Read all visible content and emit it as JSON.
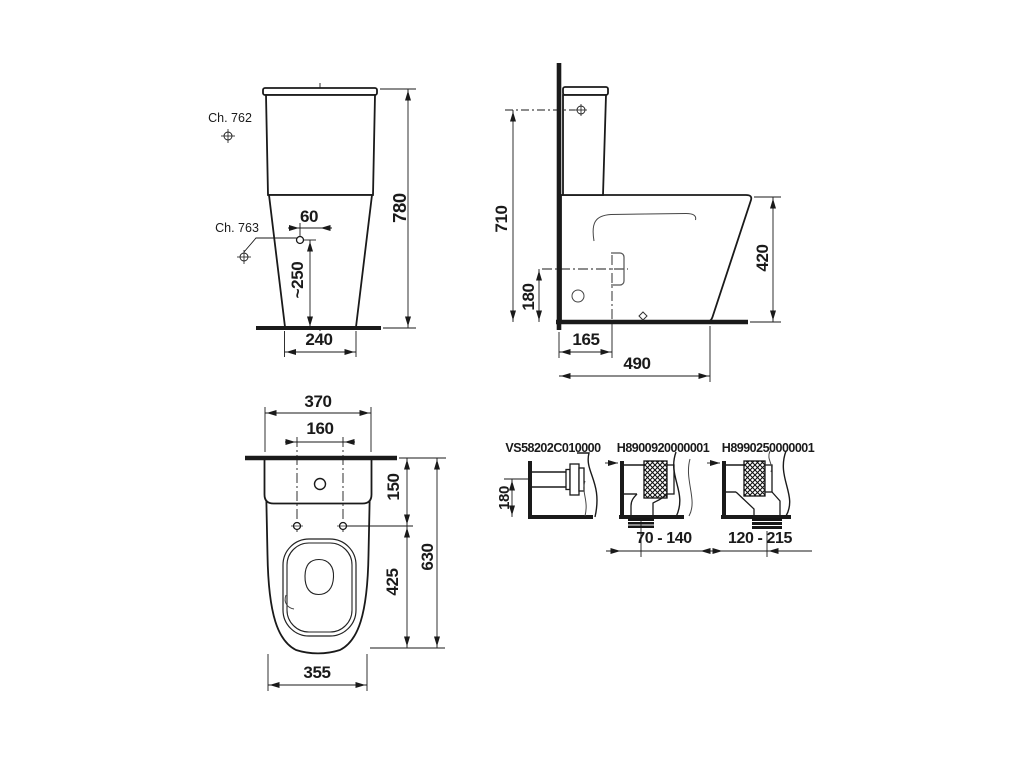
{
  "drawing": {
    "front": {
      "ch762": "Ch. 762",
      "ch763": "Ch. 763",
      "dim_60": "60",
      "dim_780": "780",
      "dim_250": "~250",
      "dim_240": "240"
    },
    "side": {
      "dim_710": "710",
      "dim_180": "180",
      "dim_165": "165",
      "dim_490": "490",
      "dim_420": "420"
    },
    "plan": {
      "dim_370": "370",
      "dim_160": "160",
      "dim_150": "150",
      "dim_630": "630",
      "dim_425": "425",
      "dim_355": "355"
    },
    "details": [
      {
        "code": "VS58202C010000",
        "dim": "180"
      },
      {
        "code": "H8900920000001",
        "dim": "70 - 140"
      },
      {
        "code": "H8990250000001",
        "dim": "120 - 215"
      }
    ]
  },
  "colors": {
    "ink": "#1a1a1a",
    "background": "#ffffff"
  }
}
